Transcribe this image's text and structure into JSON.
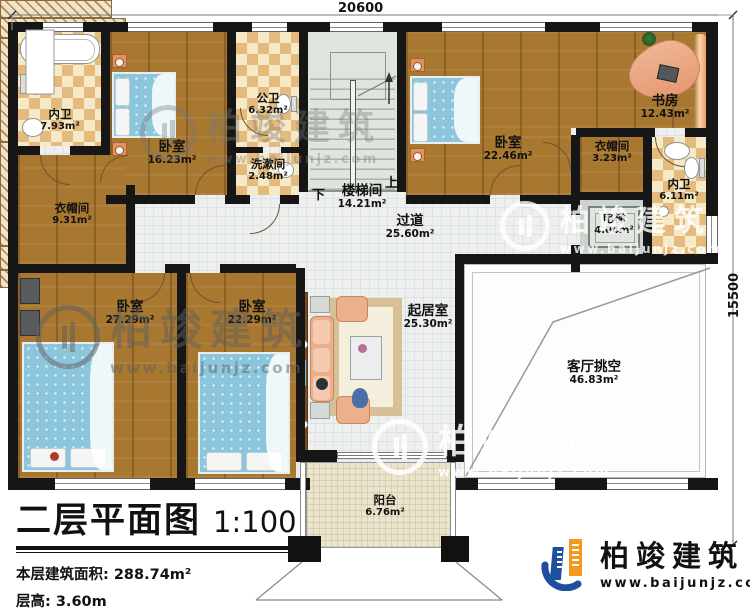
{
  "plan": {
    "dimensions": {
      "width_mm": "20600",
      "height_mm": "15500"
    },
    "rooms": {
      "neiwei_top": {
        "name": "内卫",
        "area": "7.93m²"
      },
      "bedroom_16": {
        "name": "卧室",
        "area": "16.23m²"
      },
      "gongwei": {
        "name": "公卫",
        "area": "6.32m²"
      },
      "xishujian": {
        "name": "洗漱间",
        "area": "2.48m²"
      },
      "loutijian": {
        "name": "楼梯间",
        "area": "14.21m²"
      },
      "bedroom_2246": {
        "name": "卧室",
        "area": "22.46m²"
      },
      "shufang": {
        "name": "书房",
        "area": "12.43m²"
      },
      "yimaojian_s": {
        "name": "衣帽间",
        "area": "3.23m²"
      },
      "neiwei_right": {
        "name": "内卫",
        "area": "6.11m²"
      },
      "dianti": {
        "name": "电梯",
        "area": "4.04m²"
      },
      "yimaojian_l": {
        "name": "衣帽间",
        "area": "9.31m²"
      },
      "guodao": {
        "name": "过道",
        "area": "25.60m²"
      },
      "bedroom_2729": {
        "name": "卧室",
        "area": "27.29m²"
      },
      "bedroom_2229": {
        "name": "卧室",
        "area": "22.29m²"
      },
      "qijushi": {
        "name": "起居室",
        "area": "25.30m²"
      },
      "tiaokong": {
        "name": "客厅挑空",
        "area": "46.83m²"
      },
      "yangtai": {
        "name": "阳台",
        "area": "6.76m²"
      }
    },
    "stair": {
      "down": "下",
      "up": "上"
    }
  },
  "title_block": {
    "title": "二层平面图",
    "scale": "1:100",
    "floor_area_line": "本层建筑面积: 288.74m²",
    "floor_height_line": "层高: 3.60m"
  },
  "brand": {
    "name": "柏竣建筑",
    "website": "www.baijunjz.com",
    "color_blue": "#1d4f9c",
    "color_orange": "#f29a1d"
  }
}
